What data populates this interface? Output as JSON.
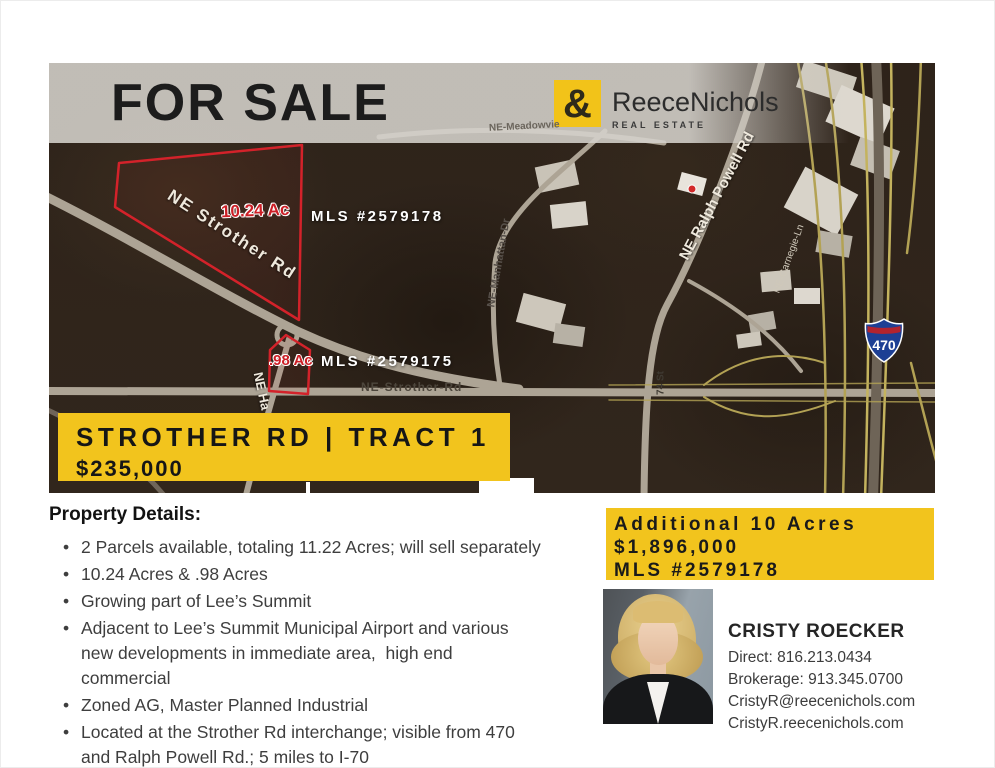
{
  "header": {
    "for_sale": "FOR SALE",
    "brand": {
      "amp": "&",
      "name": "ReeceNichols",
      "tagline": "REAL ESTATE"
    }
  },
  "map": {
    "parcels": [
      {
        "acres": "10.24 Ac",
        "mls": "MLS #2579178"
      },
      {
        "acres": ".98 Ac",
        "mls": "MLS #2579175"
      }
    ],
    "roads": {
      "strother_diag": "NE Strother Rd",
      "strother_horiz": "NE-Strother-Rd",
      "meadowview": "NE-Meadowvie",
      "manhattan": "NE-Manhattan-Dr",
      "ralph_powell": "NE Ralph Powell Rd",
      "carnegie": "NE-Carnegie-Ln",
      "hagan": "NE Ha",
      "st74": "74 St"
    },
    "interstate": "470"
  },
  "banner": {
    "title": "STROTHER RD | TRACT 1",
    "price": "$235,000"
  },
  "details": {
    "heading": "Property Details:",
    "bullets": [
      "2 Parcels available, totaling 11.22 Acres; will sell separately",
      "10.24 Acres & .98 Acres",
      "Growing part of Lee’s Summit",
      "Adjacent to Lee’s Summit Municipal Airport and various\nnew developments in immediate area,  high end\ncommercial",
      "Zoned AG, Master Planned Industrial",
      "Located at the Strother Rd interchange; visible from 470\nand Ralph Powell Rd.; 5 miles to I-70"
    ]
  },
  "additional": {
    "line1": "Additional 10 Acres",
    "line2": "$1,896,000",
    "line3": "MLS #2579178"
  },
  "agent": {
    "name": "CRISTY ROECKER",
    "direct": "Direct: 816.213.0434",
    "brokerage": "Brokerage: 913.345.0700",
    "email": "CristyR@reecenichols.com",
    "website": "CristyR.reecenichols.com"
  },
  "colors": {
    "accent_yellow": "#F2C41D",
    "parcel_red": "#D3222A",
    "map_base": "#2E231A"
  }
}
